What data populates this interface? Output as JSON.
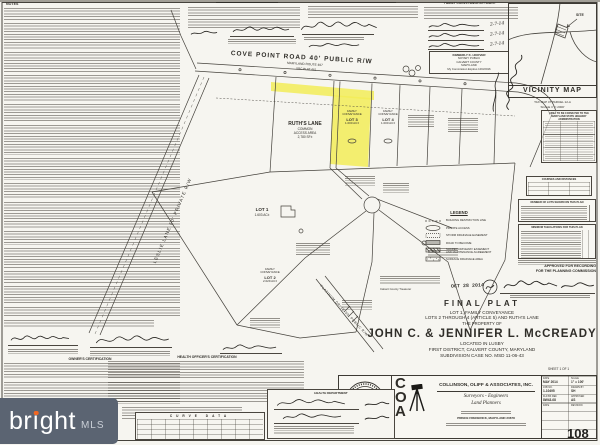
{
  "mls": {
    "brand": "bright",
    "suffix": "MLS"
  },
  "notes": {
    "title": "NOTES"
  },
  "certs": {
    "family_affidavit": "FAMILY CONVEYANCE AFFIDAVIT",
    "owners": "OWNER'S CERTIFICATION",
    "health": "HEALTH OFFICER'S CERTIFICATION",
    "health_dept": "HEALTH DEPARTMENT"
  },
  "affidavit_dates": [
    "2-7-14",
    "2-7-14",
    "2-7-14"
  ],
  "notary": {
    "name": "KIMBERLY K. HOOVER",
    "title": "NOTARY PUBLIC",
    "county": "CALVERT COUNTY",
    "state": "MARYLAND",
    "expires": "My Commission Expires 10/3/2016"
  },
  "roads": {
    "cove_point": "COVE POINT ROAD 40' PUBLIC R/W",
    "cove_point_sub1": "MARYLAND ROUTE 497",
    "cove_point_sub2": "SRC PLAT 461",
    "leslie": "LESLIE LANE 50' PRIVATE R/W",
    "platinum": "PLATINUM DRIVE 50' PUBLIC R/W"
  },
  "vicinity": {
    "title": "VICINITY MAP",
    "site": "SITE",
    "tax_map": "TAX MAP 47 PARCEL 12-A",
    "scale": "SCALE 1\" = 2000'"
  },
  "sha_table": {
    "t1": "AREA TO BE CONVEYED TO THE",
    "t2": "MARYLAND STATE HIGHWAY",
    "t3": "ADMINISTRATION"
  },
  "tables": {
    "courses": "COURSES AND DISTANCES",
    "num_lots": "NUMBER OF LOTS SHOWN ON THIS PLAN",
    "min_tabs": "MINIMUM TABULATIONS FOR THIS PLAN",
    "curve": "CURVE DATA"
  },
  "approval": {
    "line1": "APPROVED FOR RECORDING",
    "line2": "FOR THE PLANNING COMMISSION"
  },
  "treasurer": {
    "stamp_date": "OCT 28 2014",
    "label": "Calvert County Treasurer"
  },
  "parcels": {
    "ruths": {
      "l1": "RUTH'S LANE",
      "l2": "COMMON",
      "l3": "ACCESS AREA",
      "l4": "2,780 SF±"
    },
    "lot1": {
      "l1": "LOT 1",
      "l2": "1.603 AC±"
    },
    "lot2": {
      "l1": "FAMILY",
      "l2": "CONVEYANCE",
      "l3": "LOT 2",
      "l4": "2.029 AC±"
    },
    "lot3": {
      "l1": "FAMILY",
      "l2": "CONVEYANCE",
      "l3": "LOT 3",
      "l4": "1.000 AC±"
    },
    "lot4": {
      "l1": "FAMILY",
      "l2": "CONVEYANCE",
      "l3": "LOT 4",
      "l4": "1.000 AC±"
    }
  },
  "legend": {
    "title": "LEGEND",
    "items": [
      "BUILDING RESTRICTION LINE",
      "PRIVATE ACCESS",
      "STORM DRAINAGE EASEMENT",
      "ROAD TO BECOME",
      "SHARED DRIVEWAY EASEMENT AND MAINTENANCE AGREEMENT",
      "SURFACE DRAINAGE AREA"
    ]
  },
  "title_area": {
    "final_plat": "FINAL PLAT",
    "sub1": "LOT 1, FAMILY CONVEYANCE",
    "sub2": "LOTS 2 THROUGH 4 (ARTICLE 5) AND RUTH'S LANE",
    "sub3": "THE PROPERTY OF",
    "owner": "JOHN C. & JENNIFER L. McCREADY",
    "loc1": "LOCATED IN LUSBY",
    "loc2": "FIRST DISTRICT, CALVERT COUNTY, MARYLAND",
    "loc3": "SUBDIVISION CASE NO. MSD 11-06-43",
    "sheet": "SHEET 1 OF 1"
  },
  "firm": {
    "c": "C",
    "o": "O",
    "a": "A",
    "name": "COLLINSON, OLIFF & ASSOCIATES, INC.",
    "tag1": "Surveyors  -  Engineers",
    "tag2": "Land Planners",
    "city": "PRINCE FREDERICK, MARYLAND 20678",
    "seal_date": "8-13-2014"
  },
  "info_table": {
    "r1l": "DATE",
    "r1v": "MAY 2014",
    "r1l2": "SCALE",
    "r1v2": "1\" = 100'",
    "r2l": "JOB NO.",
    "r2v": "1-10495",
    "r2l2": "DRAWN BY",
    "r2v2": "SH",
    "r3l": "FLD BK REF.",
    "r3v": "8W43-08",
    "r3l2": "APPROVED",
    "r3v2": "AS",
    "r4l": "DATE",
    "r4l2": "REVISION"
  },
  "page_stamp": "108"
}
